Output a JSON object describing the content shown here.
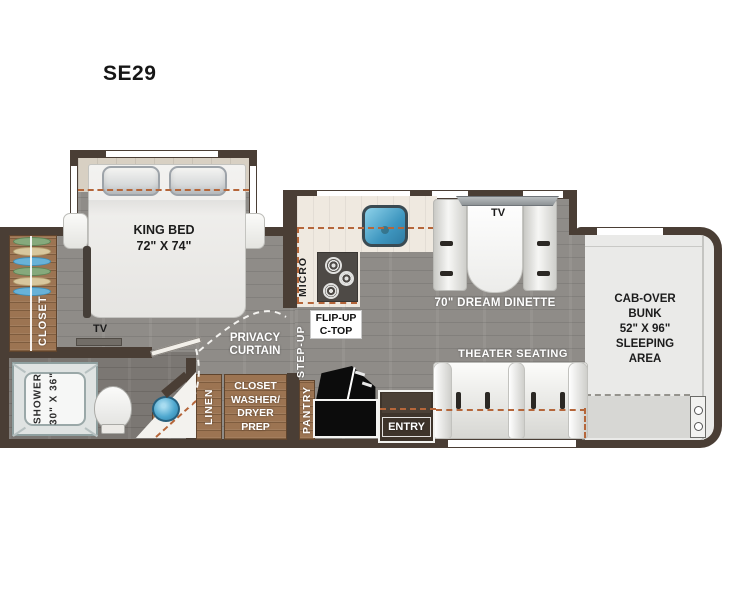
{
  "title": "SE29",
  "colors": {
    "wall": "#4a3e35",
    "floor_gray": "#8f8c88",
    "floor_bath": "#7b7773",
    "floor_light_wood": "#d9cdbb",
    "cabinet_wood": "#9c7452",
    "counter": "#efe9e0",
    "sink_blue": "#4fa8cf",
    "accent_dashed": "#b5663a",
    "appliance_black": "#0c0c0c"
  },
  "bedroom": {
    "bed_line1": "KING BED",
    "bed_line2": "72\" X 74\"",
    "tv": "TV",
    "closet": "CLOSET",
    "privacy_line1": "PRIVACY",
    "privacy_line2": "CURTAIN"
  },
  "bathroom": {
    "shower_line1": "SHOWER",
    "shower_line2": "30\" X 36\""
  },
  "kitchen": {
    "micro": "MICRO",
    "flip_line1": "FLIP-UP",
    "flip_line2": "C-TOP",
    "step_up": "STEP-UP"
  },
  "storage": {
    "linen": "LINEN",
    "wd_line1": "CLOSET",
    "wd_line2": "WASHER/",
    "wd_line3": "DRYER",
    "wd_line4": "PREP",
    "pantry": "PANTRY",
    "entry": "ENTRY"
  },
  "living": {
    "dinette_tv": "TV",
    "dinette": "70\" DREAM DINETTE",
    "theater": "THEATER SEATING"
  },
  "cab": {
    "line1": "CAB-OVER",
    "line2": "BUNK",
    "line3": "52\" X 96\"",
    "line4": "SLEEPING",
    "line5": "AREA"
  }
}
